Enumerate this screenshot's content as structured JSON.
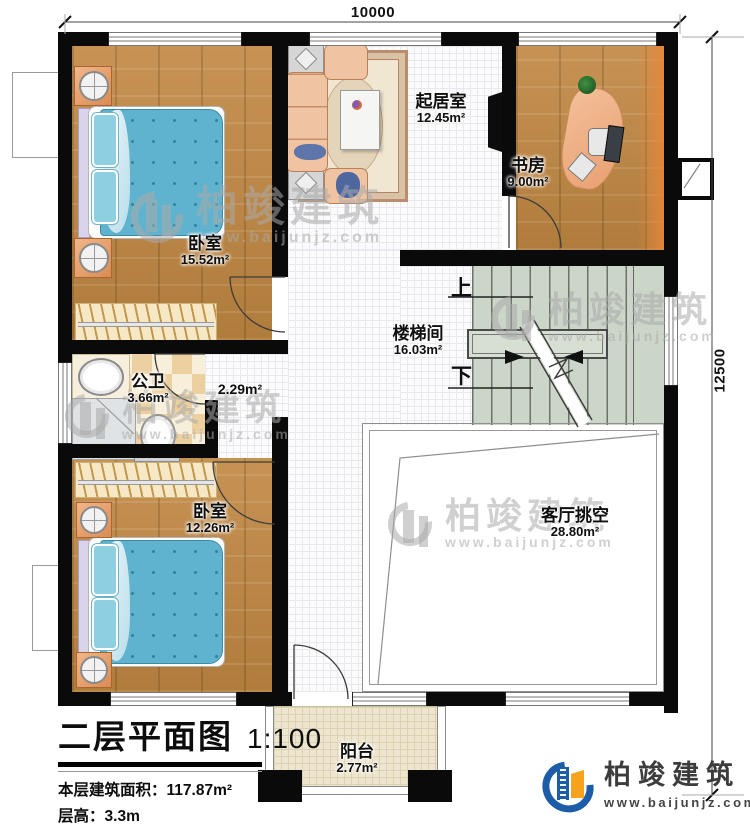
{
  "title_block": {
    "title": "二层平面图",
    "scale": "1:100",
    "area_label": "本层建筑面积：",
    "area_value": "117.87m²",
    "height_label": "层高：",
    "height_value": "3.3m"
  },
  "dimensions": {
    "width": "10000",
    "depth": "12500"
  },
  "rooms": {
    "bedroom1": {
      "name": "卧室",
      "area": "15.52m²"
    },
    "living": {
      "name": "起居室",
      "area": "12.45m²"
    },
    "study": {
      "name": "书房",
      "area": "9.00m²"
    },
    "stairwell": {
      "name": "楼梯间",
      "area": "16.03m²"
    },
    "bathroom": {
      "name": "公卫",
      "area": "3.66m²"
    },
    "hall": {
      "area": "2.29m²"
    },
    "bedroom2": {
      "name": "卧室",
      "area": "12.26m²"
    },
    "void": {
      "name": "客厅挑空",
      "area": "28.80m²"
    },
    "balcony": {
      "name": "阳台",
      "area": "2.77m²"
    }
  },
  "stairs": {
    "up": "上",
    "down": "下"
  },
  "watermark": {
    "name": "柏竣建筑",
    "url": "www.baijunjz.com"
  },
  "brand": {
    "name": "柏竣建筑",
    "url": "www.baijunjz.com"
  },
  "colors": {
    "wall": "#0a0a0a",
    "accent_blue": "#1d5da8",
    "accent_orange": "#f6a21d",
    "bed_blue": "#5fb3cf",
    "stair_green": "#ccd6c8"
  }
}
